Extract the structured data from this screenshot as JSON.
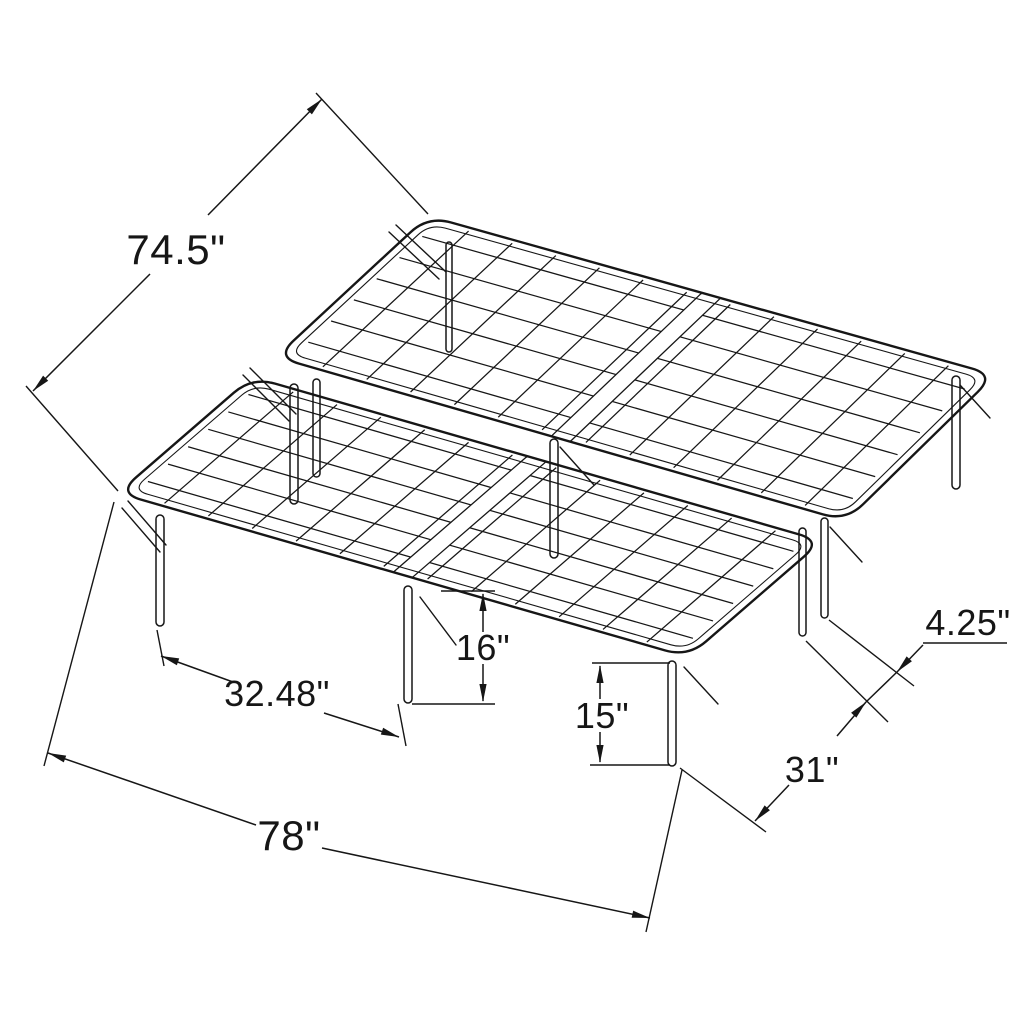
{
  "title": "Folding platform bed frame dimension drawing",
  "diagram": {
    "product": "metal folding platform bed frame",
    "style": "isometric technical line drawing",
    "line_color": "#161616",
    "background_color": "#ffffff",
    "dimensions": {
      "frame_width": "74.5\"",
      "frame_length": "78\"",
      "front_leg_spacing": "32.48\"",
      "overall_height": "16\"",
      "leg_height": "15\"",
      "seam_leg_gap": "4.25\"",
      "side_leg_spacing": "31\""
    }
  }
}
